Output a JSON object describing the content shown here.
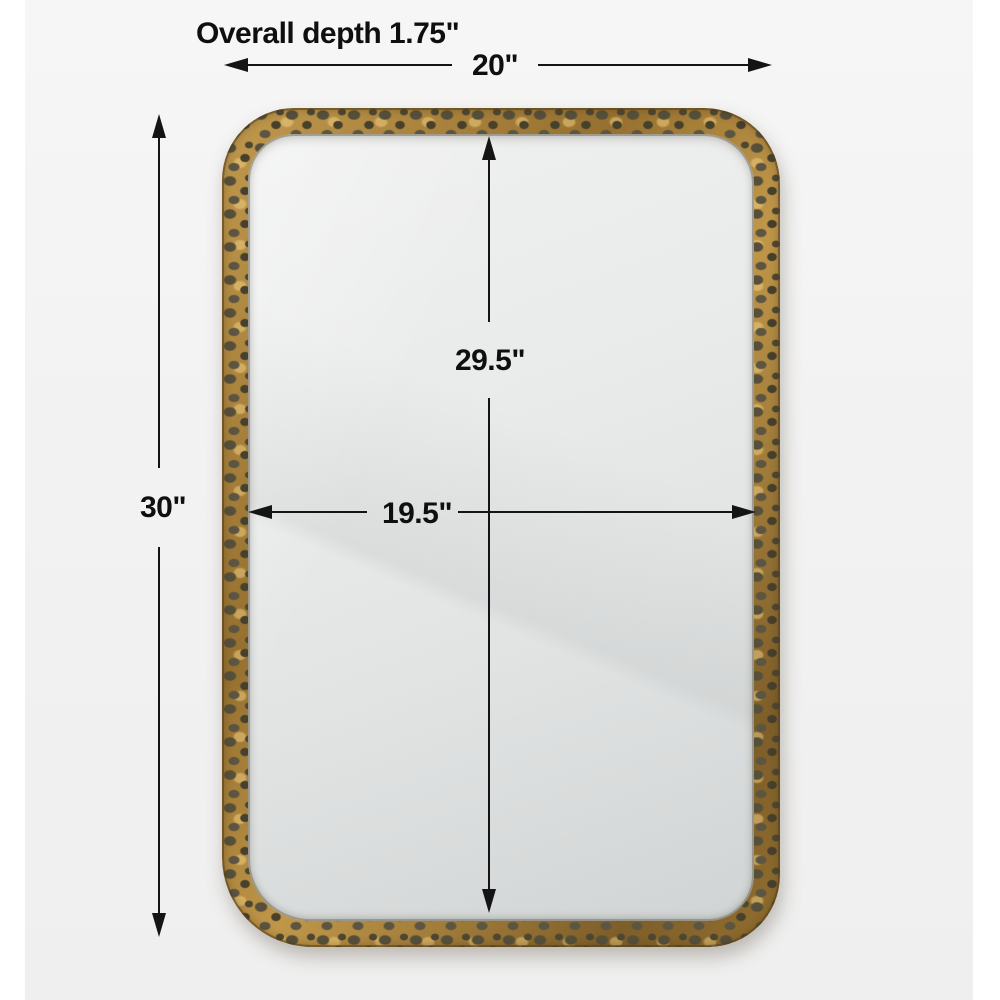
{
  "page": {
    "background_color": "#ffffff",
    "photo_background_color": "#f2f2f2"
  },
  "labels": {
    "overall_depth": "Overall depth 1.75\"",
    "overall_width": "20\"",
    "overall_height": "30\"",
    "mirror_height": "29.5\"",
    "mirror_width": "19.5\""
  },
  "colors": {
    "dimension_line": "#141414",
    "label_text": "#0f0f0f",
    "frame_gold": "#a87e3c",
    "frame_gold_light": "#c29a4e",
    "frame_gold_dark": "#7e5e29",
    "frame_hammer_spot": "#4c4532",
    "glass_light": "#efefef",
    "glass_dark": "#d0d4d4"
  },
  "figure": {
    "type": "rectangular wall mirror",
    "frame_finish": "hammered antique gold",
    "shape": "rounded-corner rectangle"
  }
}
